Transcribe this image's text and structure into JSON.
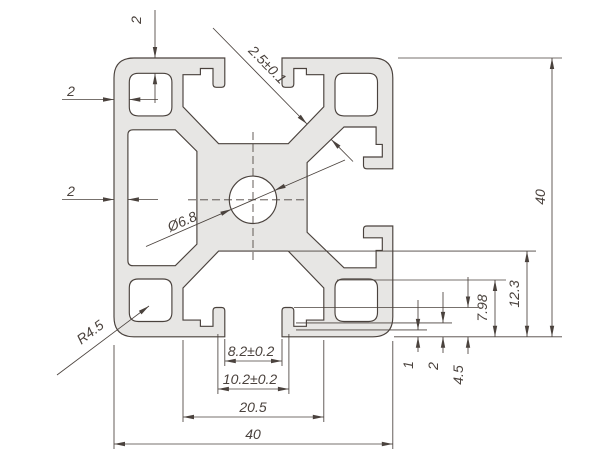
{
  "drawing": {
    "description": "Aluminium extrusion profile 40x40 cross-section dimension drawing, one closed side, open T-slots top/right/bottom",
    "colors": {
      "background": "#ffffff",
      "profile_fill": "#e7e6e4",
      "line": "#4a423d"
    },
    "dims": {
      "top_wall": "2",
      "left_wall_upper": "2",
      "left_wall_lower": "2",
      "web_thickness": "2.5±0.1",
      "center_hole": "Ø6.8",
      "corner_radius": "R4.5",
      "overall_height": "40",
      "core_depth": "12.3",
      "slot_depth": "7.98",
      "lip_depth": "4.5",
      "lip_wall": "2",
      "lip_step": "1",
      "slot_opening": "8.2±0.2",
      "slot_inner_width": "10.2±0.2",
      "slot_span": "20.5",
      "overall_width": "40"
    }
  }
}
